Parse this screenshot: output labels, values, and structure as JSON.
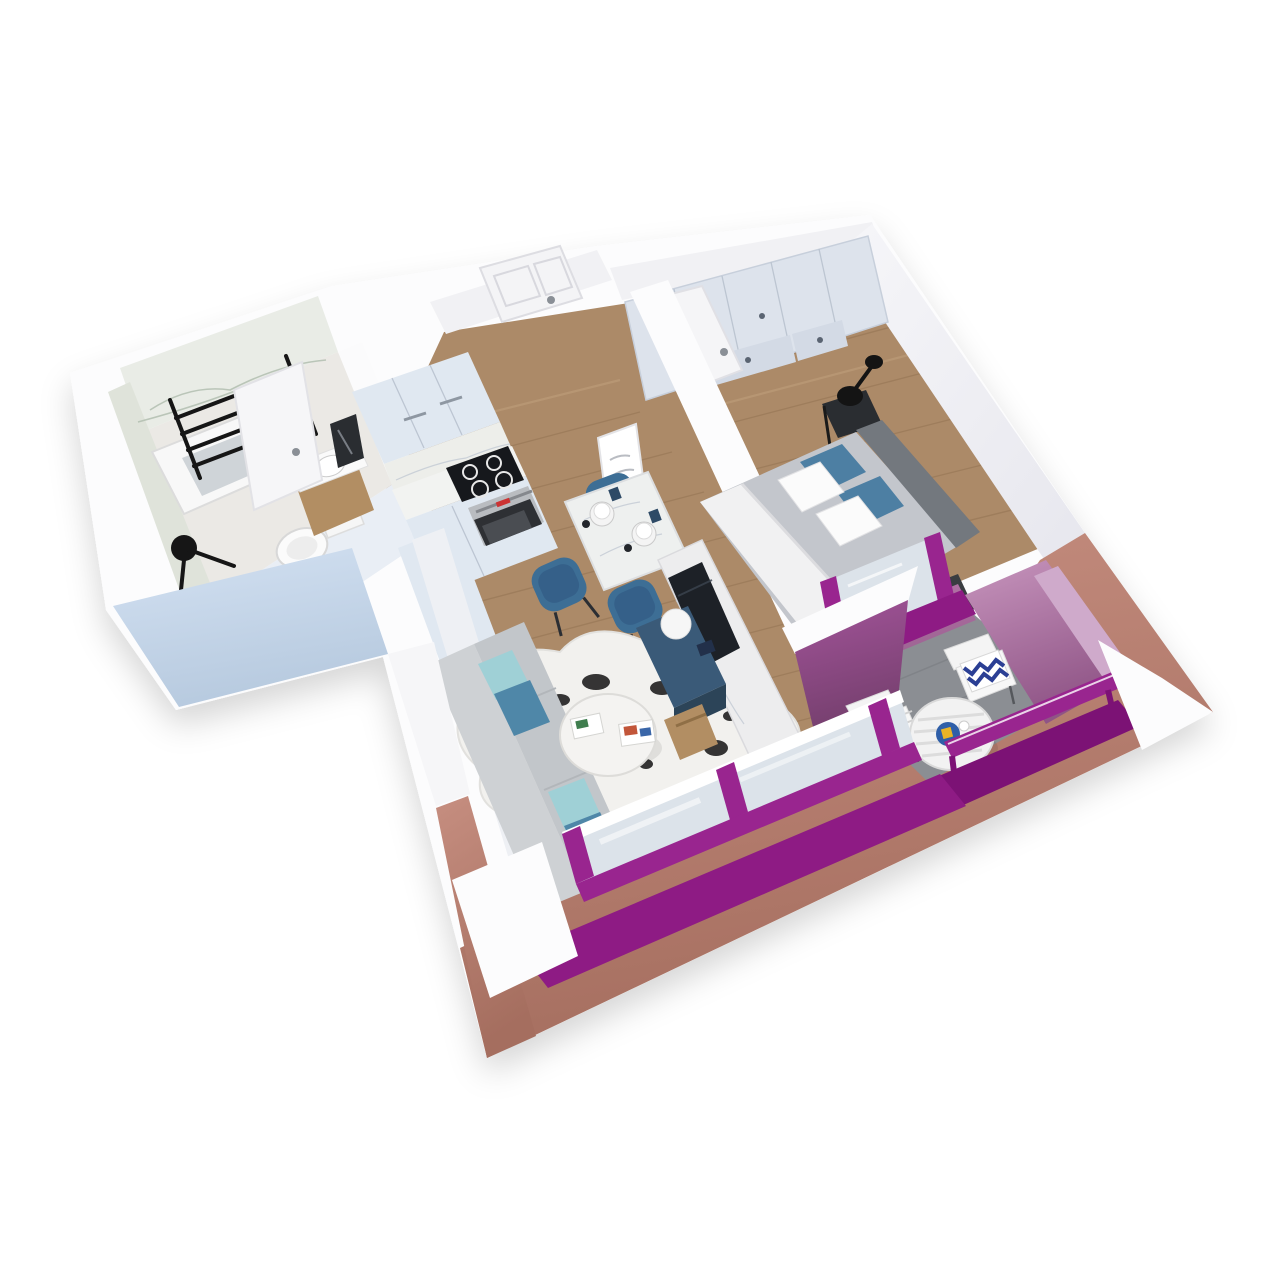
{
  "meta": {
    "title": "3D isometric cutaway floor plan render of a one-bedroom apartment",
    "canvas_w": 1280,
    "canvas_h": 1280
  },
  "palette": {
    "bg": "#ffffff",
    "wallCut": "#fcfcfd",
    "wallFace": "#f1f1f4",
    "wallShade": "#e3e3ea",
    "extBlueLight": "#d3e1f2",
    "extBlueDark": "#b7cadf",
    "extMauveLight": "#c68e80",
    "extMauveDark": "#a56e5f",
    "magenta": "#8e1b84",
    "magentaDark": "#7c1275",
    "magentaFrame": "#99258f",
    "balconyPinkLight": "#c795bd",
    "balconyPinkDark": "#8f5486",
    "balconyPurpleLight": "#a3549a",
    "balconyPurpleDark": "#6e3c67",
    "balconyBackLight": "#b877ab",
    "balconyBackDark": "#975f8d",
    "lavender": "#cfaacb",
    "wood": "#ac8a68",
    "woodLine": "#8f6f4e",
    "woodLight": "#c2a27f",
    "bathFloor": "#ebe9e5",
    "marble": "#e9ece6",
    "marbleVein": "#aebbac",
    "glass": "#dce3ea",
    "sofa": "#ced1d4",
    "sofaSeat": "#c2c6ca",
    "tealDark": "#4f87a8",
    "tealLight": "#9fd0d6",
    "bedDuvet": "#c3c6cc",
    "headboard": "#73787e",
    "bedBlue": "#4d7fa3",
    "chairBlue": "#3d6e95",
    "cabinet": "#e0e8f1",
    "cabinetDark": "#c6d2e0",
    "navy": "#3a5a78",
    "navyDark": "#2c4458",
    "cooktop": "#16181c",
    "oven": "#2e3034",
    "steel": "#b9bcc0",
    "balconyFloor": "#8b8e93",
    "woodFurn": "#b28e63",
    "black": "#161616",
    "white": "#fafafa",
    "rug": "#f2f1ee",
    "tvScreen": "#1d2127"
  },
  "scene": {
    "type": "architectural-3d-render",
    "rooms": [
      {
        "name": "bathroom",
        "furniture": [
          "shower-tub",
          "towel-ladder",
          "toilet",
          "vanity-sink",
          "mirror",
          "shower-fixture",
          "open-door"
        ]
      },
      {
        "name": "hallway",
        "furniture": [
          "entry-door"
        ]
      },
      {
        "name": "kitchen",
        "furniture": [
          "upper-cabinets",
          "marble-backsplash",
          "cooktop",
          "oven",
          "base-cabinets",
          "tall-cabinet"
        ]
      },
      {
        "name": "dining-area",
        "furniture": [
          "marble-table",
          "blue-chairs",
          "table-setting",
          "wall-art-frame"
        ]
      },
      {
        "name": "living-room",
        "furniture": [
          "corner-sofa",
          "teal-pillows",
          "cowhide-rug",
          "coffee-table",
          "tv-console",
          "marble-tv-panel",
          "tv",
          "sphere-lamp",
          "wood-crate",
          "floor-lamp",
          "blue-stool",
          "front-window"
        ]
      },
      {
        "name": "bedroom",
        "furniture": [
          "wardrobe",
          "double-bed",
          "headboard",
          "pillows",
          "nightstand-left",
          "nightstand-right",
          "black-lamp",
          "open-door",
          "balcony-door"
        ]
      },
      {
        "name": "balcony",
        "furniture": [
          "slatted-table",
          "slatted-chairs",
          "chevron-pillow",
          "serving-tray",
          "railing"
        ]
      }
    ]
  }
}
